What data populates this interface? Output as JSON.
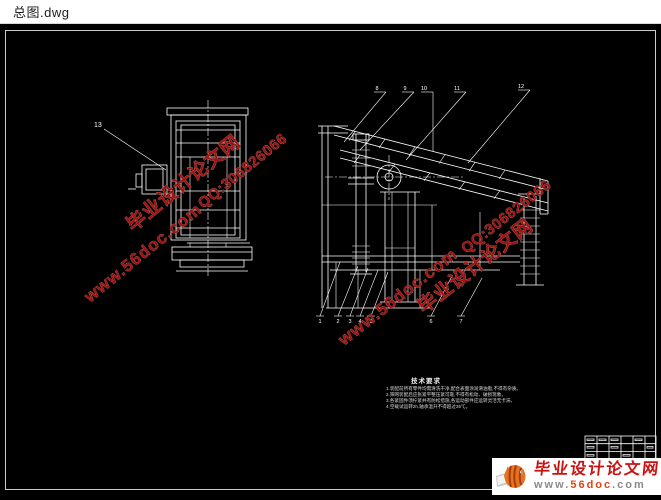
{
  "window": {
    "title": "总图.dwg"
  },
  "colors": {
    "canvas_bg": "#000000",
    "line": "#ffffff",
    "watermark": "#9e1512",
    "logo_red": "#cc1111",
    "logo_orange": "#e8731f"
  },
  "watermark": {
    "site": "www.56doc.com",
    "name": "毕业设计论文网",
    "qq": "QQ:306826066"
  },
  "notes": {
    "heading": "技术要求",
    "lines": [
      "1.装配前所有零件均需清洗干净,配合表面涂润滑油脂,不得有杂质。",
      "2.筛网装配后应张紧平整压紧可靠,不得有松动、破损现象。",
      "3.各紧固件须拧紧并有防松措施,各运动部件应运转灵活无卡滞。",
      "4.空载试运转2h,轴承温升不得超过35℃。"
    ]
  },
  "callouts": {
    "left_view": "13",
    "top": [
      "8",
      "9",
      "10",
      "11",
      "12"
    ],
    "bottom": [
      "1",
      "2",
      "3",
      "4",
      "5",
      "6",
      "7"
    ]
  },
  "logo": {
    "name": "毕业设计论文网",
    "url_www": "www.",
    "url_site": "56doc",
    "url_com": ".com"
  }
}
